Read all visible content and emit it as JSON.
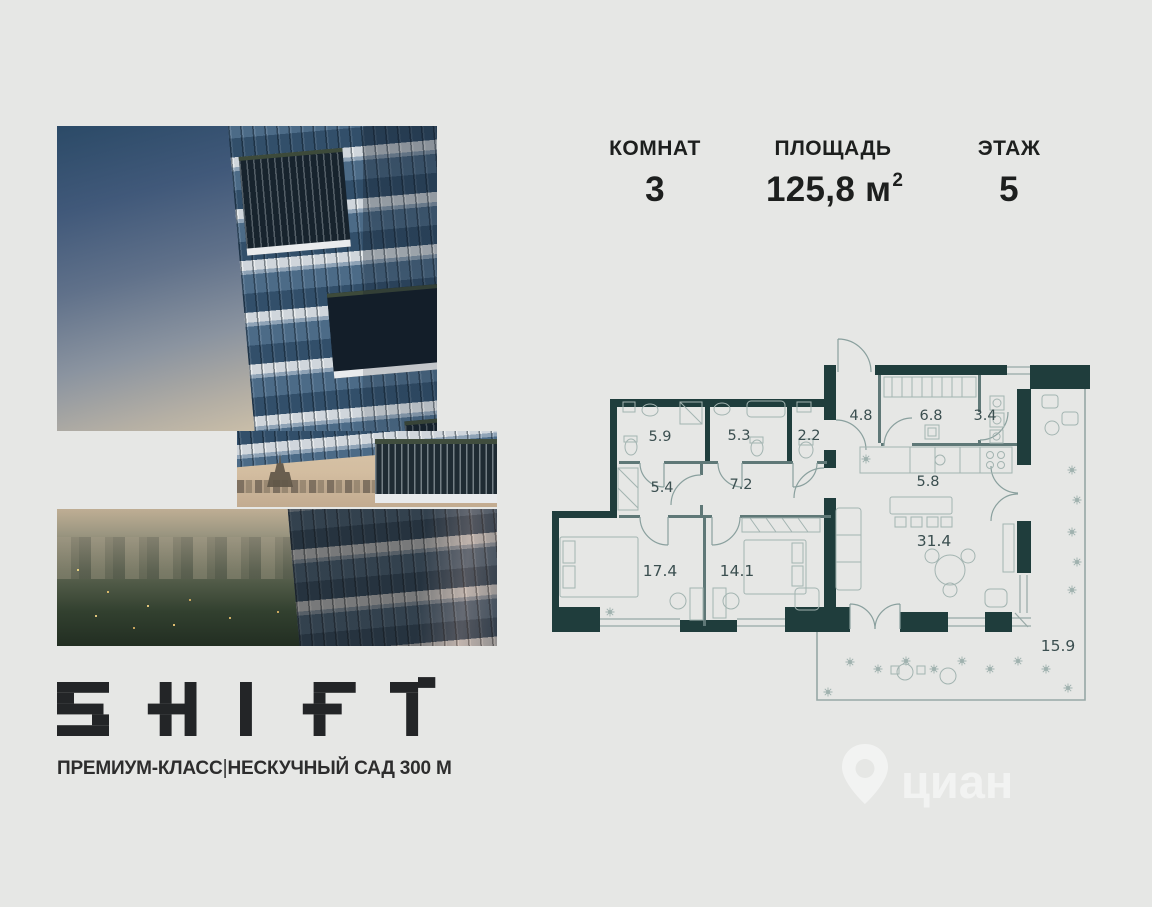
{
  "page": {
    "background": "#e6e7e5"
  },
  "header": {
    "stats": [
      {
        "label": "КОМНАТ",
        "value": "3"
      },
      {
        "label": "ПЛОЩАДЬ",
        "value": "125,8",
        "unit": "м",
        "unit_exp": "2"
      },
      {
        "label": "ЭТАЖ",
        "value": "5"
      }
    ]
  },
  "photo": {
    "sky_top": "#2c4b68",
    "horizon": "#d2c4aa",
    "dusk_green": "#32402f",
    "slab_white": "#e8eaec",
    "glass_blue": "#33506b"
  },
  "floorplan": {
    "wall_color": "#1f3d3c",
    "line_color": "#97a8a6",
    "label_color": "#3b4f50",
    "rooms": [
      {
        "name": "bathroom-1",
        "area": "5.9"
      },
      {
        "name": "bathroom-2",
        "area": "5.3"
      },
      {
        "name": "wc",
        "area": "2.2"
      },
      {
        "name": "hall-entry",
        "area": "4.8"
      },
      {
        "name": "kitchen",
        "area": "6.8"
      },
      {
        "name": "laundry",
        "area": "3.4"
      },
      {
        "name": "corridor-1",
        "area": "5.4"
      },
      {
        "name": "corridor-2",
        "area": "7.2"
      },
      {
        "name": "kitchen-zone",
        "area": "5.8"
      },
      {
        "name": "bedroom-1",
        "area": "17.4"
      },
      {
        "name": "bedroom-2",
        "area": "14.1"
      },
      {
        "name": "living-room",
        "area": "31.4"
      },
      {
        "name": "terrace",
        "area": "15.9"
      }
    ]
  },
  "logo": {
    "brand": "SHIFT",
    "tagline_left": "ПРЕМИУМ-КЛАСС",
    "separator": "|",
    "tagline_right": "НЕСКУЧНЫЙ САД 300 М"
  },
  "watermark": {
    "text": "циан"
  }
}
